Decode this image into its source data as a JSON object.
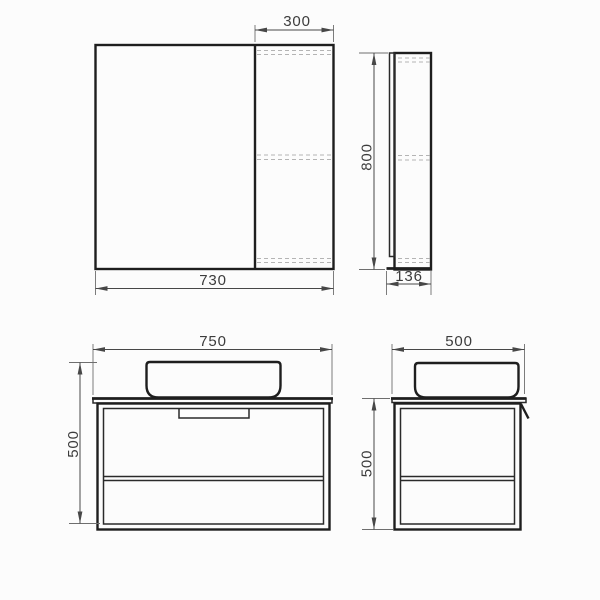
{
  "document": {
    "type": "technical-dimension-drawing",
    "subject": "bathroom mirror cabinet and vanity unit with countertop basin",
    "background_color": "#fcfcfc",
    "outline_color": "#1e1e1e",
    "hidden_line_color": "#b4b4b4",
    "dimension_color": "#474747",
    "units": "mm"
  },
  "views": {
    "mirror_cabinet_front": {
      "name": "mirror cabinet — front view",
      "overall_width": "730",
      "door_section_width": "300"
    },
    "mirror_cabinet_side": {
      "name": "mirror cabinet — side view",
      "overall_height": "800",
      "depth": "136"
    },
    "vanity_front": {
      "name": "vanity unit — front view",
      "overall_width": "750",
      "overall_height": "500"
    },
    "vanity_side": {
      "name": "vanity unit — side view",
      "depth": "500",
      "overall_height": "500"
    }
  }
}
